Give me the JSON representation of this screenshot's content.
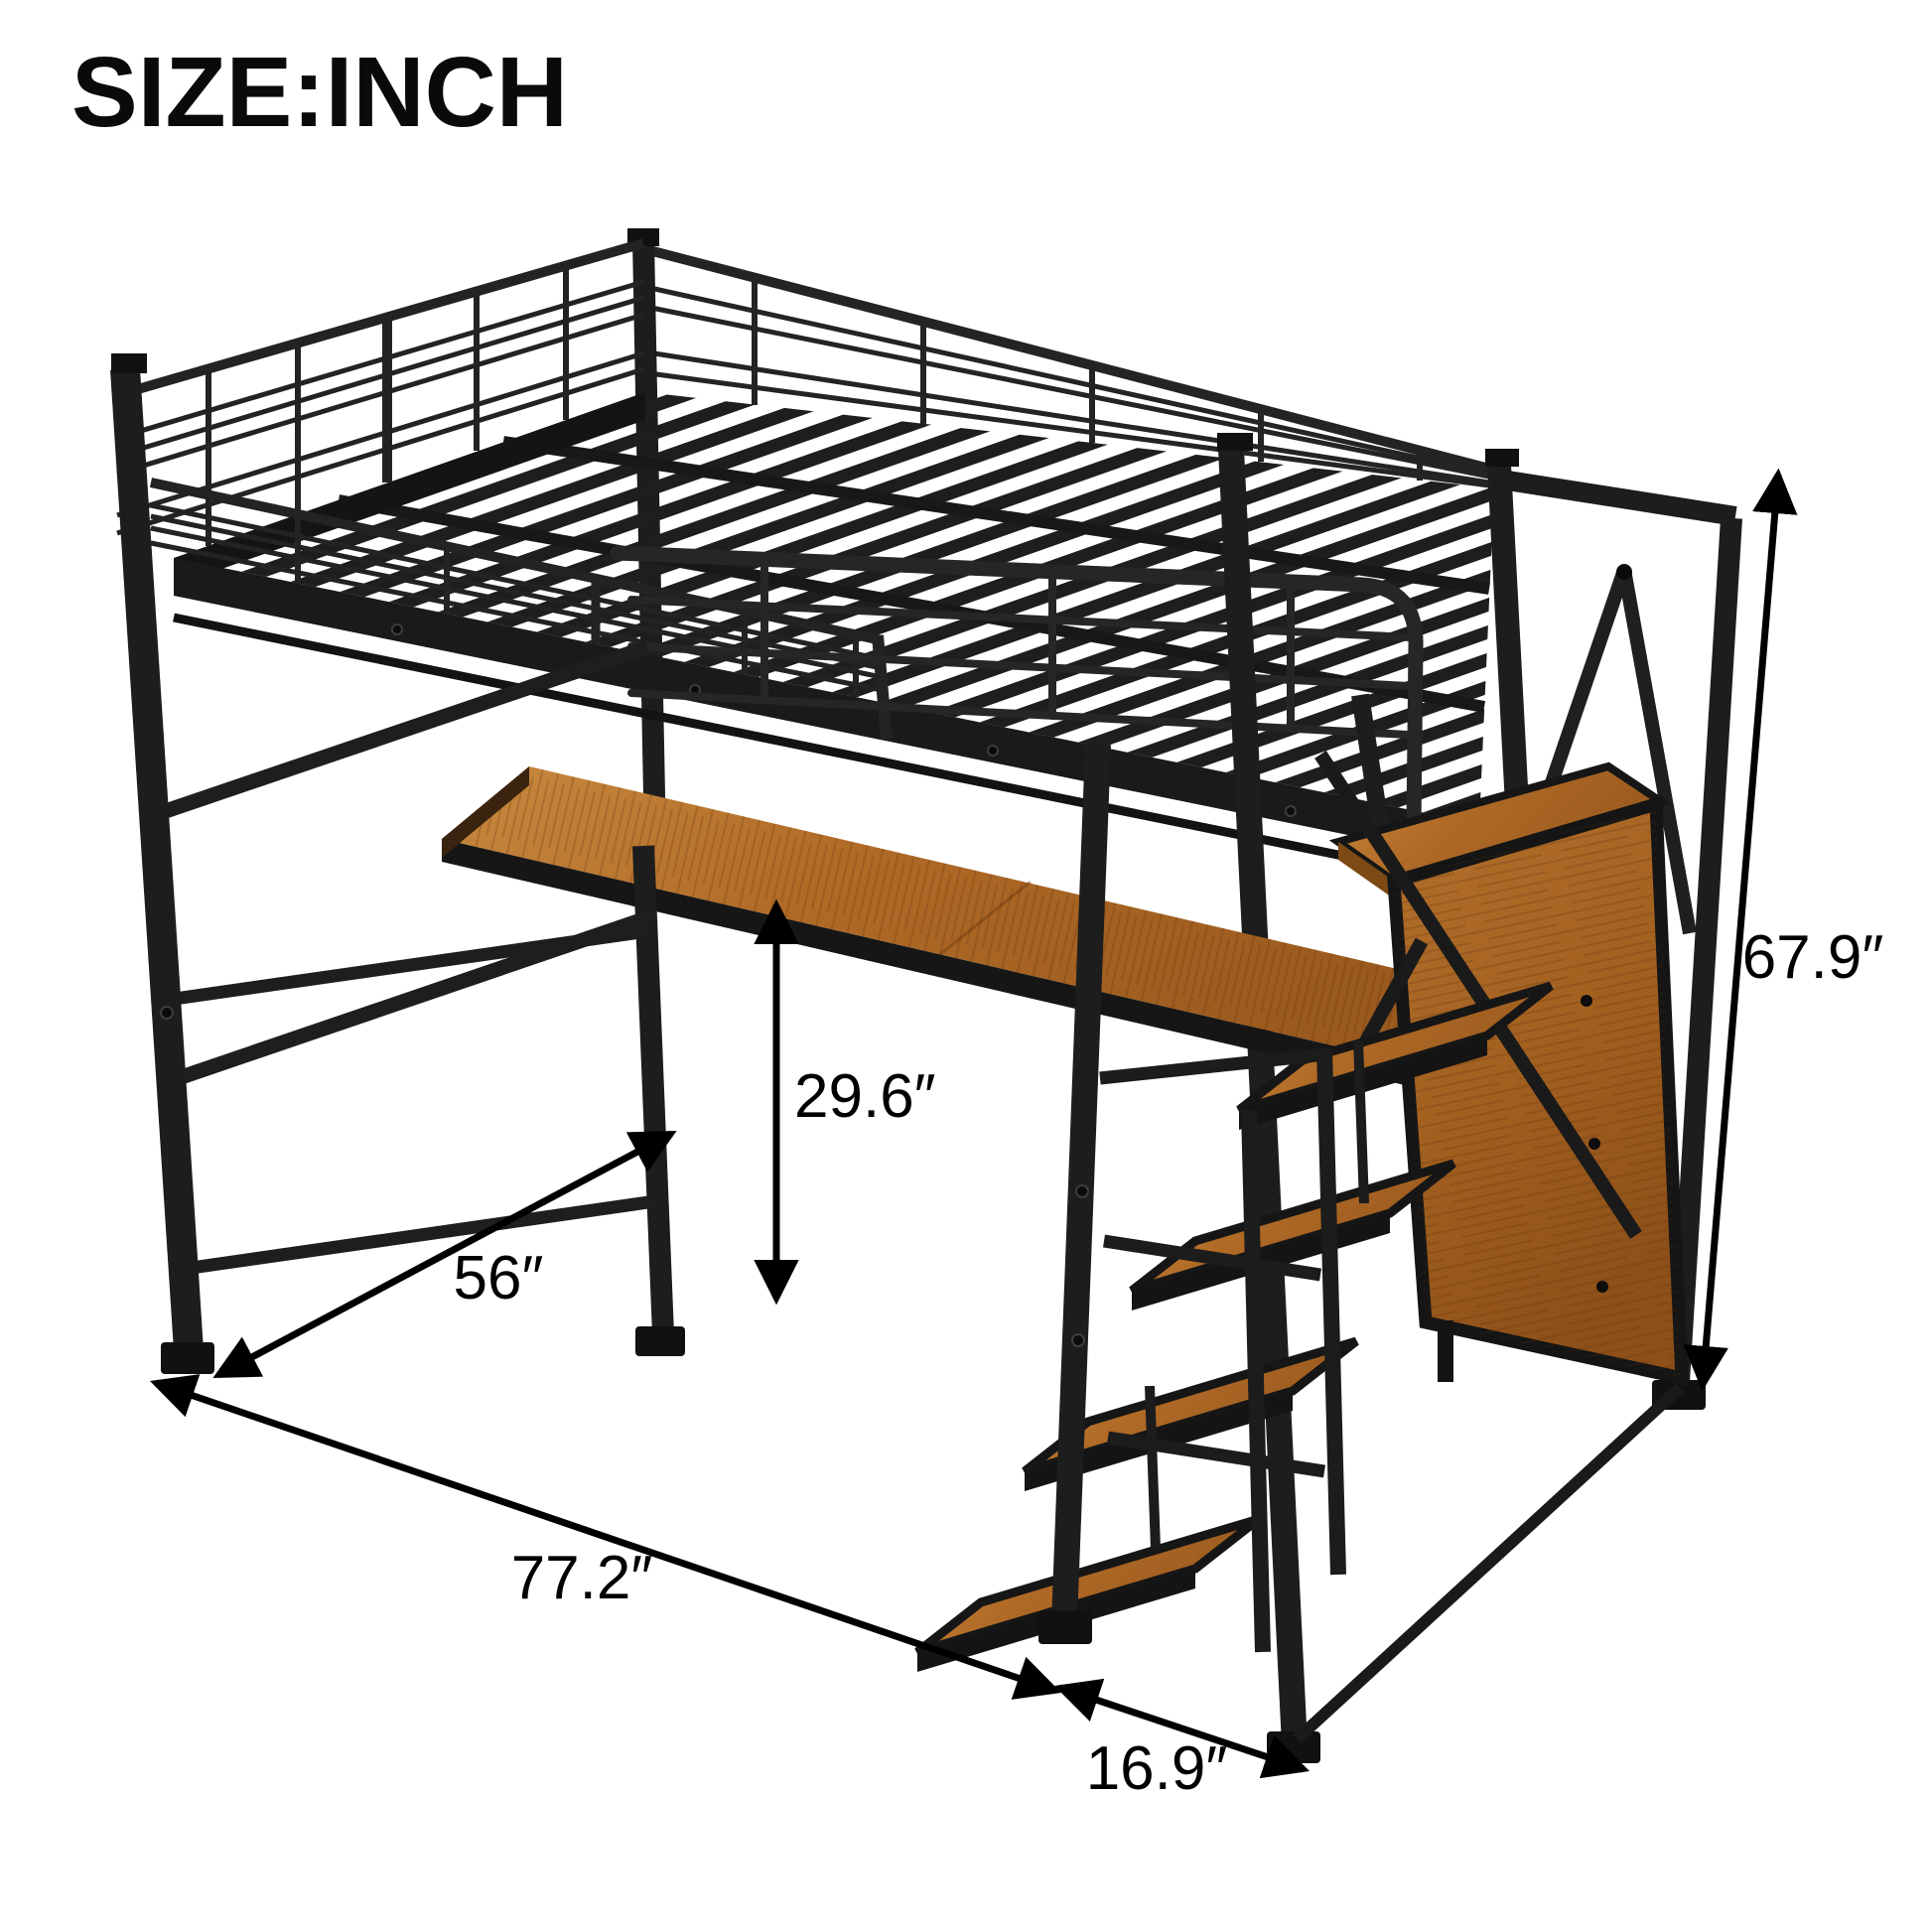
{
  "header": {
    "title": "SIZE:INCH",
    "unit": "inch"
  },
  "dimensions": {
    "overall_height": {
      "label": "67.9″"
    },
    "desk_height": {
      "label": "29.6″"
    },
    "desk_length": {
      "label": "56″"
    },
    "bed_length": {
      "label": "77.2″"
    },
    "stair_depth": {
      "label": "16.9″"
    }
  },
  "colors": {
    "frame": "#1f1f1f",
    "wood": "#a9681f",
    "wood_light": "#c98a3f",
    "wood_dark": "#8e5019",
    "arrow": "#000000",
    "background": "#ffffff"
  }
}
